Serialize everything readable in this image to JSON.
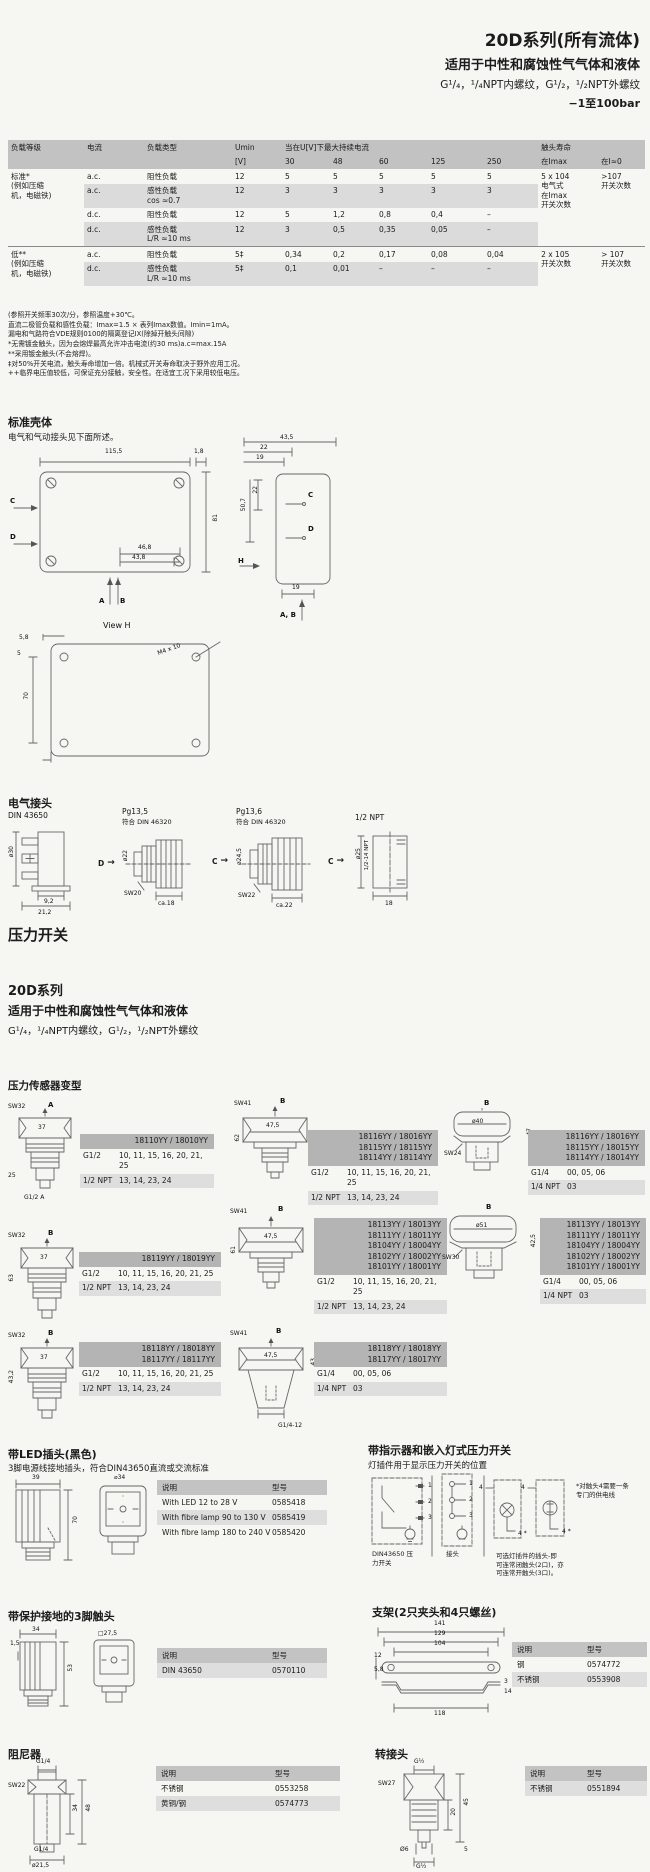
{
  "header": {
    "title": "20D系列(所有流体)",
    "subtitle": "适用于中性和腐蚀性气气体和液体",
    "threads": "G¹/₄，¹/₄NPT内螺纹，G¹/₂，¹/₂NPT外螺纹",
    "pressure_range": "−1至100bar"
  },
  "load_table": {
    "h_grade": "负载等级",
    "h_current": "电流",
    "h_type": "负载类型",
    "h_umin": "Umin",
    "h_umin2": "[V]",
    "h_maxcur": "当在U[V]下最大持续电流",
    "h_v": [
      "30",
      "48",
      "60",
      "125",
      "250"
    ],
    "h_life": "触头寿命",
    "h_life2": "在Imax",
    "h_i0": "在I≈0",
    "rows": [
      {
        "grade": "标准*\n(例如压缩\n机，电磁铁)",
        "current": "a.c.",
        "type": "阻性负载",
        "umin": "12",
        "v": [
          "5",
          "5",
          "5",
          "5",
          "5"
        ],
        "life": "5 x 104\n电气式\n在Imax\n开关次数",
        "i0": ">107\n开关次数"
      },
      {
        "current": "a.c.",
        "type": "感性负载\ncos ≈0.7",
        "umin": "12",
        "v": [
          "3",
          "3",
          "3",
          "3",
          "3"
        ]
      },
      {
        "current": "d.c.",
        "type": "阻性负载",
        "umin": "12",
        "v": [
          "5",
          "1,2",
          "0,8",
          "0,4",
          "–"
        ]
      },
      {
        "current": "d.c.",
        "type": "感性负载\nL/R ≈10 ms",
        "umin": "12",
        "v": [
          "3",
          "0,5",
          "0,35",
          "0,05",
          "–"
        ]
      },
      {
        "grade": "低**\n(例如压缩\n机，电磁铁)",
        "current": "a.c.",
        "type": "阻性负载",
        "umin": "5‡",
        "v": [
          "0,34",
          "0,2",
          "0,17",
          "0,08",
          "0,04"
        ],
        "life": "2 x 105\n开关次数",
        "i0": "> 107\n开关次数"
      },
      {
        "current": "d.c.",
        "type": "感性负载\nL/R ≈10 ms",
        "umin": "5‡",
        "v": [
          "0,1",
          "0,01",
          "–",
          "–",
          "–"
        ]
      }
    ]
  },
  "notes": [
    "(参照开关频率30次/分，参照温度+30℃。",
    "直流二极管负载和感性负载：Imax=1.5 × 表列Imax数值。Imin=1mA。",
    "漏电和气路符合VDE规则0100的隔离登记IX(除掉开触头间隙)",
    "*无需镀金触头，因为会熔焊最高允许冲击电流(约30 ms)a.c=max.15A",
    "**采用镀金触头(不会熔焊)。",
    "‡对50%开关电流，触头寿命增加一倍。机械式开关寿命取决于野外应用工况。",
    "++临界电压值较低，可保证充分接触，安全性。在适宜工况下采用较低电压。"
  ],
  "housing": {
    "heading": "标准壳体",
    "sub": "电气和气动接头见下面所述。",
    "front": {
      "w": "115,5",
      "t": "1,8",
      "h": "81",
      "b1": "46,8",
      "b2": "43,8",
      "c": "C",
      "d": "D",
      "a": "A",
      "b": "B"
    },
    "side": {
      "d1": "43,5",
      "d2": "22",
      "d3": "19",
      "d4": "22",
      "d5": "50,7",
      "d6": "19",
      "h": "H",
      "c": "C",
      "d": "D",
      "ab": "A, B"
    },
    "viewh": {
      "title": "View H",
      "d1": "5,8",
      "d2": "5",
      "d3": "70",
      "d4": "M4 x 10"
    }
  },
  "connectors": {
    "heading": "电气接头",
    "c1": {
      "title": "DIN 43650",
      "dia": "ø30",
      "d1": "9,2",
      "d2": "21,2",
      "arrow": "D"
    },
    "c2": {
      "title": "Pg13,5",
      "sub": "符合 DIN 46320",
      "dia": "ø22",
      "sw": "SW20",
      "w": "ca.18",
      "arrow": "C"
    },
    "c3": {
      "title": "Pg13,6",
      "sub": "符合 DIN 46320",
      "dia": "ø24,5",
      "sw": "SW22",
      "w": "ca.22",
      "arrow": "C"
    },
    "c4": {
      "title": "1/2 NPT",
      "dia": "ø25",
      "thread": "1/2-14 NPT",
      "w": "18"
    }
  },
  "switch_heading": "压力开关",
  "series": {
    "title": "20D系列",
    "subtitle": "适用于中性和腐蚀性气气体和液体",
    "threads": "G¹/₄，¹/₄NPT内螺纹，G¹/₂，¹/₂NPT外螺纹"
  },
  "variants": {
    "heading": "压力传感器变型",
    "items": [
      {
        "sw": "SW32",
        "dir": "A",
        "w": "37",
        "h": "25",
        "thread": "G1/2 A",
        "models": "18110YY / 18010YY",
        "r1l": "G1/2",
        "r1v": "10, 11, 15, 16, 20, 21, 25",
        "r2l": "1/2 NPT",
        "r2v": "13, 14, 23, 24"
      },
      {
        "sw": "SW41",
        "dir": "B",
        "w": "47,5",
        "h": "62",
        "models": "18116YY / 18016YY\n18115YY / 18115YY\n18114YY / 18114YY",
        "r1l": "G1/2",
        "r1v": "10, 11, 15, 16, 20, 21, 25",
        "r2l": "1/2 NPT",
        "r2v": "13, 14, 23, 24"
      },
      {
        "sw": "SW24",
        "dir": "B",
        "dia": "ø40",
        "h": "47",
        "models": "18116YY / 18016YY\n18115YY / 18015YY\n18114YY / 18014YY",
        "r1l": "G1/4",
        "r1v": "00, 05, 06",
        "r2l": "1/4 NPT",
        "r2v": "03"
      },
      {
        "sw": "SW32",
        "dir": "B",
        "w": "37",
        "h": "63",
        "models": "18119YY / 18019YY",
        "r1l": "G1/2",
        "r1v": "10, 11, 15, 16, 20, 21, 25",
        "r2l": "1/2 NPT",
        "r2v": "13, 14, 23, 24"
      },
      {
        "sw": "SW41",
        "dir": "B",
        "w": "47,5",
        "h": "61",
        "models": "18113YY / 18013YY\n18111YY / 18011YY\n18104YY / 18004YY\n18102YY / 18002YY\n18101YY / 18001YY",
        "r1l": "G1/2",
        "r1v": "10, 11, 15, 16, 20, 21, 25",
        "r2l": "1/2 NPT",
        "r2v": "13, 14, 23, 24"
      },
      {
        "sw": "SW30",
        "dir": "B",
        "dia": "ø51",
        "h": "42,5",
        "models": "18113YY / 18013YY\n18111YY / 18011YY\n18104YY / 18004YY\n18102YY / 18002YY\n18101YY / 18001YY",
        "r1l": "G1/4",
        "r1v": "00, 05, 06",
        "r2l": "1/4 NPT",
        "r2v": "03"
      },
      {
        "sw": "SW32",
        "dir": "B",
        "w": "37",
        "h": "43,2",
        "models": "18118YY / 18018YY\n18117YY / 18117YY",
        "r1l": "G1/2",
        "r1v": "10, 11, 15, 16, 20, 21, 25",
        "r2l": "1/2 NPT",
        "r2v": "13, 14, 23, 24"
      },
      {
        "sw": "SW41",
        "dir": "B",
        "w": "47,5",
        "h": "43",
        "thread": "G1/4-12",
        "models": "18118YY / 18018YY\n18117YY / 18017YY",
        "r1l": "G1/4",
        "r1v": "00, 05, 06",
        "r2l": "1/4 NPT",
        "r2v": "03"
      }
    ]
  },
  "led_plug": {
    "heading": "带LED插头(黑色)",
    "sub": "3脚电源线接地插头，符合DIN43650直流或交流标准",
    "d1": "39",
    "d2": "⌀34",
    "d3": "70",
    "table": {
      "h1": "说明",
      "h2": "型号",
      "rows": [
        {
          "desc": "With LED 12 to 28 V",
          "part": "0585418"
        },
        {
          "desc": "With fibre lamp 90 to 130 V",
          "part": "0585419"
        },
        {
          "desc": "With fibre lamp 180 to 240 V",
          "part": "0585420"
        }
      ]
    }
  },
  "indicator": {
    "heading": "带指示器和嵌入灯式压力开关",
    "sub": "灯插件用于显示压力开关的位置",
    "pin1": "1",
    "pin2": "2",
    "pin3": "3",
    "four": "4",
    "four_star": "4 *",
    "label_switch": "DIN43650 压\n力开关",
    "label_plug": "接头",
    "note1": "*对触头4需要一条\n专门的供电线",
    "note2": "可选灯插件的插头-即\n可连常闭触头(2口)，亦\n可连常开触头(3口)。"
  },
  "ground_contact": {
    "heading": "带保护接地的3脚触头",
    "d1": "34",
    "d2": "1,5",
    "d3": "□27,5",
    "d4": "53",
    "table": {
      "h1": "说明",
      "h2": "型号",
      "rows": [
        {
          "desc": "DIN 43650",
          "part": "0570110"
        }
      ]
    }
  },
  "bracket": {
    "heading": "支架(2只夹头和4只螺丝)",
    "d1": "141",
    "d2": "129",
    "d3": "104",
    "d4": "12",
    "d5": "5,8",
    "d6": "3",
    "d7": "14",
    "d8": "118",
    "table": {
      "h1": "说明",
      "h2": "型号",
      "rows": [
        {
          "desc": "钢",
          "part": "0574772"
        },
        {
          "desc": "不锈钢",
          "part": "0553908"
        }
      ]
    }
  },
  "damper": {
    "heading": "阻尼器",
    "d1": "G1/4",
    "d2": "SW22",
    "d3": "34",
    "d4": "48",
    "d5": "G1/4",
    "d6": "ø21,5",
    "table": {
      "h1": "说明",
      "h2": "型号",
      "rows": [
        {
          "desc": "不锈钢",
          "part": "0553258"
        },
        {
          "desc": "黄铜/钢",
          "part": "0574773"
        }
      ]
    }
  },
  "adapter": {
    "heading": "转接头",
    "d1": "G½",
    "d2": "SW27",
    "d3": "45",
    "d4": "20",
    "d5": "Ø6",
    "d6": "5",
    "d7": "G½",
    "table": {
      "h1": "说明",
      "h2": "型号",
      "rows": [
        {
          "desc": "不锈钢",
          "part": "0551894"
        }
      ]
    }
  }
}
